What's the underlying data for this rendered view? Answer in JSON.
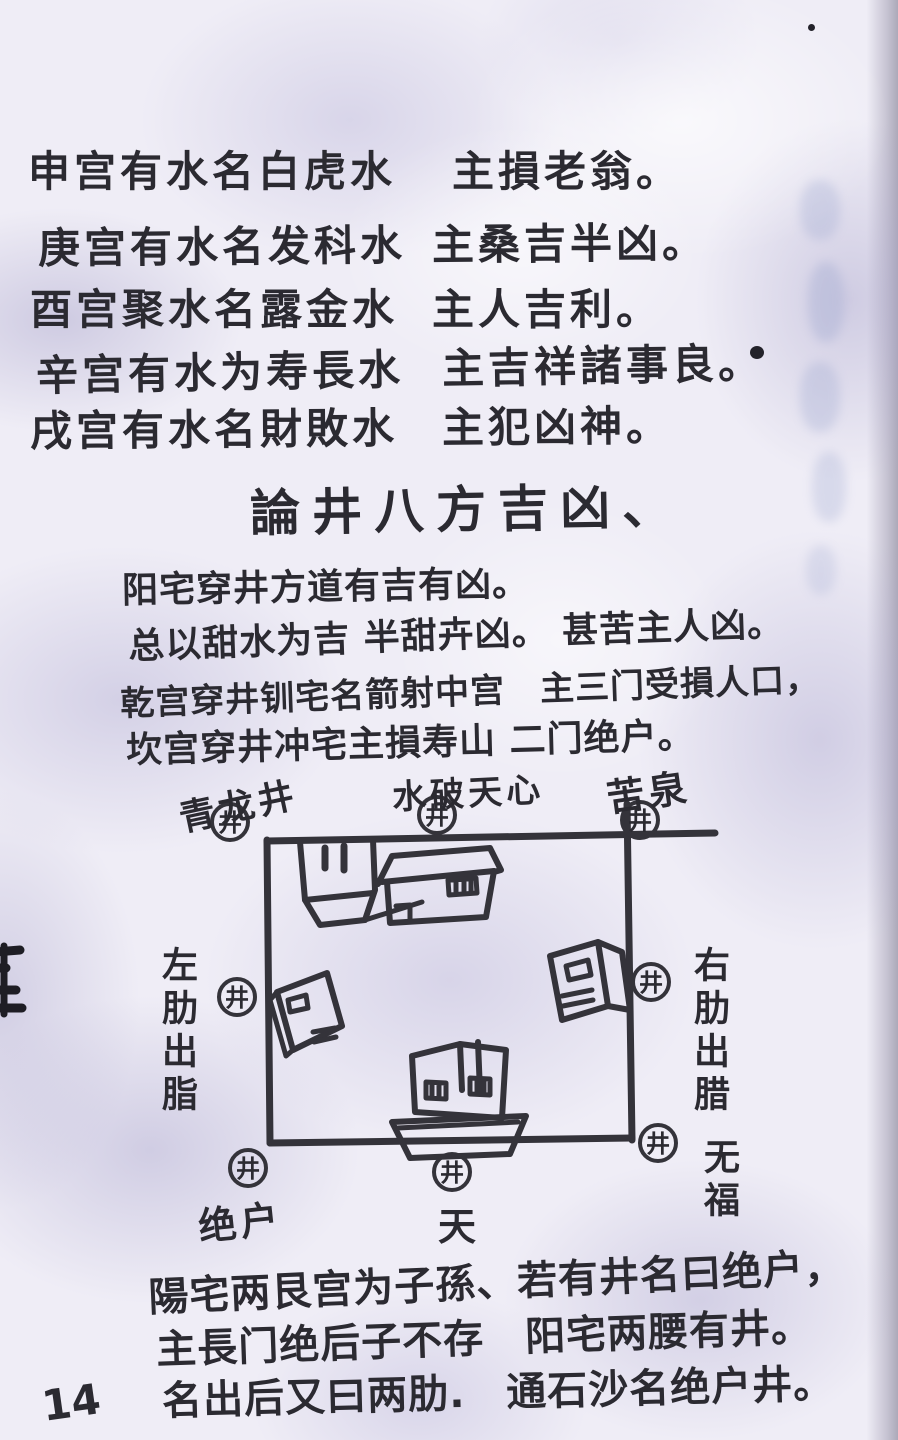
{
  "page": {
    "number": "14",
    "paper_color": "#efedf6",
    "mottle_color": "#aaa5cd",
    "ink_color": "#2b2a31"
  },
  "section1": {
    "lines": [
      {
        "c1": "申宫有水名白虎水",
        "c2": "主損老翁。"
      },
      {
        "c1": "庚宫有水名发科水",
        "c2": "主桑吉半凶。"
      },
      {
        "c1": "酉宫聚水名露金水",
        "c2": "主人吉利。"
      },
      {
        "c1": "辛宫有水为寿長水",
        "c2": "主吉祥諸事良。"
      },
      {
        "c1": "戌宫有水名財敗水",
        "c2": "主犯凶神。"
      }
    ]
  },
  "title": "論井八方吉凶、",
  "section2": {
    "lines": [
      "阳宅穿井方道有吉有凶。",
      "总以甜水为吉 半甜卉凶。 甚苦主人凶。",
      "乾宫穿井钏宅名箭射中宫　主三门受損人口，",
      "坎宫穿井冲宅主損寿山 二门绝户。"
    ]
  },
  "diagram": {
    "well_symbol": "井",
    "labels": {
      "top_left": "青龙井",
      "top_center": "水破天心",
      "top_right": "苦泉",
      "left_side": "左肋出脂",
      "right_side": "右肋出腊",
      "bottom_left": "绝户",
      "bottom_center": "天",
      "bottom_right": "无福"
    }
  },
  "section3": {
    "lines": [
      "陽宅两艮宫为子孫、若有井名曰绝户，",
      "主長门绝后子不存　阳宅两腰有井。",
      "名出后又曰两肋.　通石沙名绝户井。"
    ]
  }
}
